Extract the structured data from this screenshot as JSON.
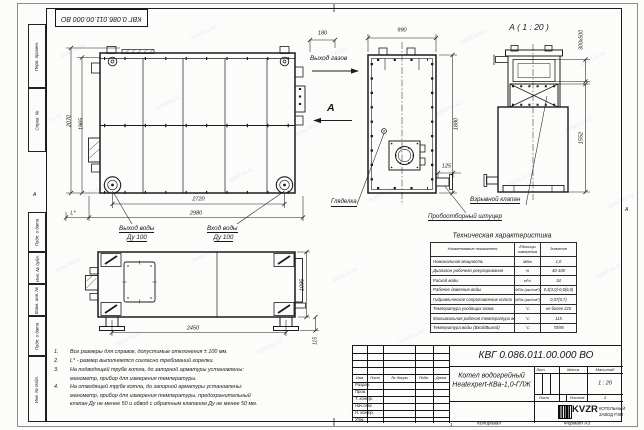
{
  "sheet": {
    "watermark": "kotel-kv.kz",
    "top_stamp": "КВГ 0.086.011.00.000 ВО",
    "zone_left": "А",
    "zone_right": "А",
    "fold_mark": "1",
    "copied_label": "Копировал",
    "format_label": "Формат А3"
  },
  "margin": {
    "labels": [
      "Перв. примен.",
      "Справ. №",
      "Подп. и дата",
      "Инв. № дубл.",
      "Взам. инв. №",
      "Подп. и дата",
      "Инв. № подл."
    ]
  },
  "views": {
    "front": {
      "dim_height_outer": "2070",
      "dim_height_inner": "1965",
      "dim_width_wheels": "2720",
      "dim_width_overall": "2980",
      "dim_burner": "L*",
      "label_water_outlet": "Выход воды",
      "label_water_outlet_dn": "Ду 100",
      "label_water_inlet": "Вход воды",
      "label_water_inlet_dn": "Ду 100"
    },
    "side": {
      "dim_offset": "180",
      "dim_width": "990",
      "dim_height": "1880",
      "dim_stub": "125",
      "label_gas_outlet": "Выход газов",
      "view_letter": "А",
      "label_sight_glass": "Гляделка",
      "label_sampling": "Пробоотборный штуцер"
    },
    "rear": {
      "title": "А ( 1 : 20 )",
      "dim_flue": "300х500",
      "dim_height": "1552",
      "label_explosion_valve": "Взрывной клапан"
    },
    "bottom": {
      "dim_width": "2450",
      "dim_depth": "1095",
      "dim_foot": "115"
    }
  },
  "notes": {
    "items": [
      {
        "num": "1.",
        "lines": [
          "Все размеры для справок, допустимые отклонения ± 100 мм."
        ]
      },
      {
        "num": "2.",
        "lines": [
          "L* - размер выполняется согласно требований горелки."
        ]
      },
      {
        "num": "3.",
        "lines": [
          "На подводящей трубе котла, до запорной арматуры установлены:",
          "манометр, прибор для измерения температуры."
        ]
      },
      {
        "num": "4.",
        "lines": [
          "На отводящей трубе котла, до запорной арматуры установлены:",
          "манометр, прибор для измерения температуры, предохранительный",
          "клапан Ду не менее 50 и обвод с обратным клапаном Ду не менее 50 мм."
        ]
      }
    ]
  },
  "spec_table": {
    "title": "Техническая характеристика",
    "headers": [
      "Наименование показателя",
      "Единицы измерения",
      "Значение"
    ],
    "rows": [
      {
        "name": "Номинальная мощность",
        "unit": "МВт",
        "value": "1,0"
      },
      {
        "name": "Диапазон рабочего регулирования",
        "unit": "%",
        "value": "40-100"
      },
      {
        "name": "Расход воды",
        "unit": "м³/ч",
        "value": "34"
      },
      {
        "name": "Рабочее давление воды",
        "unit": "МПа (кгс/см²)",
        "value": "0,3(3,0)-0,6(6,0)"
      },
      {
        "name": "Гидравлическое сопротивление котла",
        "unit": "МПа (кгс/см²)",
        "value": "0,07(0,7)"
      },
      {
        "name": "Температура уходящих газов",
        "unit": "°С",
        "value": "не более 220"
      },
      {
        "name": "Максимальная рабочая температура воды",
        "unit": "°С",
        "value": "115"
      },
      {
        "name": "Температура воды (Вход/Выход)",
        "unit": "°С",
        "value": "70/95"
      }
    ]
  },
  "title_block": {
    "doc_number": "КВГ 0.086.011.00.000 ВО",
    "product_name_line1": "Котел водогрейный",
    "product_name_line2": "Heatexpert-КВа-1,0-ГЛЖ",
    "header_cols": [
      "Изм.",
      "Лист",
      "№ докум.",
      "Подп.",
      "Дата"
    ],
    "sign_rows": [
      "Разраб.",
      "Пров.",
      "Т. контр.",
      "Нач.отд.",
      "Н. контр.",
      "Утв."
    ],
    "lit_label": "Лит.",
    "mass_label": "Масса",
    "scale_label": "Масштаб",
    "scale_value": "1 : 20",
    "sheet_label": "Лист",
    "sheets_label": "Листов",
    "sheets_value": "1",
    "logo_text": "KVZR",
    "company_line1": "КОТЕЛЬНЫЙ",
    "company_line2": "ЗАВОД РЭП"
  }
}
